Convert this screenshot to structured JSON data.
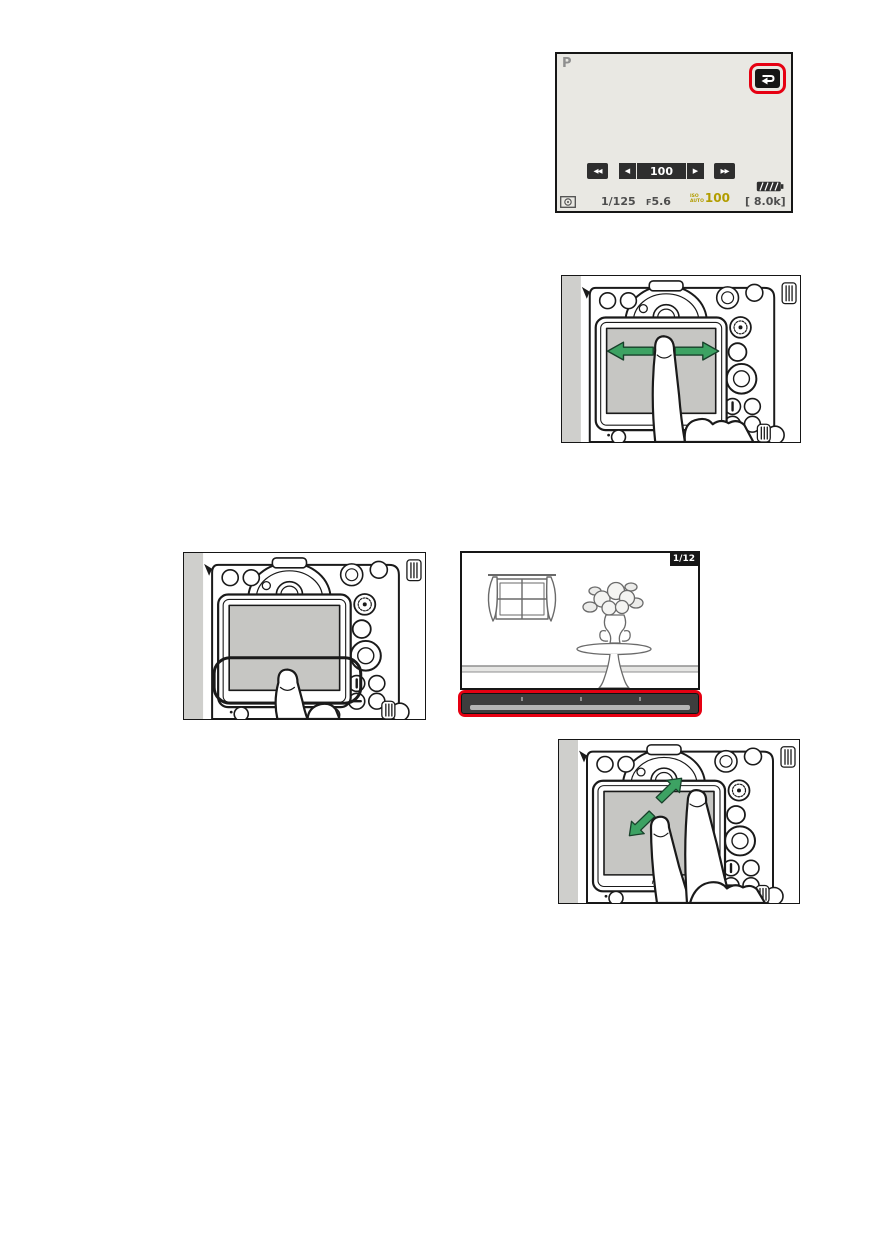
{
  "colors": {
    "highlight_red": "#e60012",
    "arrow_green": "#3da263",
    "iso_gold": "#b29d00",
    "screen_bg": "#e9e8e3",
    "lcd_gray": "#c6c6c3"
  },
  "icons": {
    "return": "return-arrow-icon",
    "metering": "matrix-metering-icon",
    "battery": "battery-level-icon",
    "swipe": "swipe-left-right-arrows",
    "tap": "tap-zone-highlight",
    "pinch": "stretch-outward-arrows"
  },
  "playback_info_screen": {
    "mode": "P",
    "frame_advance_bar": {
      "skip_back": "◀◀",
      "step_back": "◀",
      "value": "100",
      "step_forward": "▶",
      "skip_forward": "▶▶"
    },
    "status_bar": {
      "shutter_speed": "1/125",
      "aperture_prefix": "F",
      "aperture_value": "5.6",
      "iso_label_top": "ISO",
      "iso_label_bottom": "AUTO",
      "iso_value": "100",
      "exposures_remaining": "[ 8.0k]"
    }
  },
  "camera_back": {
    "brand": "Nikon"
  },
  "photo_playback_screen": {
    "frame_counter": "1/12"
  }
}
